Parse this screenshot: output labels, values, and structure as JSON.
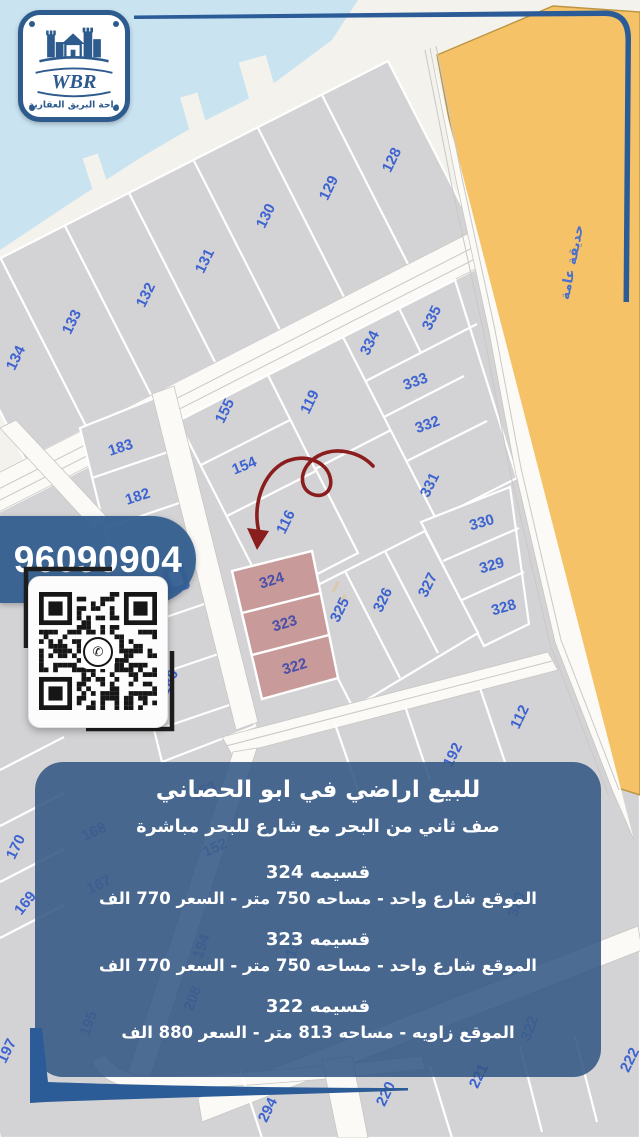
{
  "logo": {
    "brand": "WBR",
    "tagline": "واحة البريق العقارية"
  },
  "phone": "96090904",
  "map": {
    "park_label": "حديقة عامة",
    "highlighted_plots": [
      "324",
      "323",
      "322"
    ],
    "plots": [
      {
        "n": "128",
        "x": 396,
        "y": 162,
        "r": -64
      },
      {
        "n": "129",
        "x": 333,
        "y": 190,
        "r": -64
      },
      {
        "n": "130",
        "x": 270,
        "y": 218,
        "r": -64
      },
      {
        "n": "131",
        "x": 209,
        "y": 263,
        "r": -64
      },
      {
        "n": "132",
        "x": 150,
        "y": 297,
        "r": -64
      },
      {
        "n": "133",
        "x": 76,
        "y": 324,
        "r": -64
      },
      {
        "n": "134",
        "x": 20,
        "y": 360,
        "r": -64
      },
      {
        "n": "335",
        "x": 436,
        "y": 320,
        "r": -64
      },
      {
        "n": "334",
        "x": 374,
        "y": 345,
        "r": -64
      },
      {
        "n": "155",
        "x": 229,
        "y": 413,
        "r": -64
      },
      {
        "n": "119",
        "x": 314,
        "y": 404,
        "r": -64
      },
      {
        "n": "154",
        "x": 246,
        "y": 470,
        "r": -22
      },
      {
        "n": "116",
        "x": 290,
        "y": 524,
        "r": -64
      },
      {
        "n": "333",
        "x": 417,
        "y": 386,
        "r": -20
      },
      {
        "n": "332",
        "x": 429,
        "y": 429,
        "r": -20
      },
      {
        "n": "331",
        "x": 434,
        "y": 487,
        "r": -64
      },
      {
        "n": "330",
        "x": 483,
        "y": 527,
        "r": -16
      },
      {
        "n": "329",
        "x": 493,
        "y": 570,
        "r": -16
      },
      {
        "n": "328",
        "x": 505,
        "y": 612,
        "r": -16
      },
      {
        "n": "327",
        "x": 432,
        "y": 587,
        "r": -64
      },
      {
        "n": "326",
        "x": 387,
        "y": 602,
        "r": -64
      },
      {
        "n": "325",
        "x": 344,
        "y": 612,
        "r": -64
      },
      {
        "n": "324",
        "x": 273,
        "y": 585,
        "r": -17,
        "s": "h"
      },
      {
        "n": "323",
        "x": 286,
        "y": 628,
        "r": -17,
        "s": "h"
      },
      {
        "n": "322",
        "x": 296,
        "y": 671,
        "r": -17,
        "s": "h"
      },
      {
        "n": "183",
        "x": 122,
        "y": 452,
        "r": -18
      },
      {
        "n": "182",
        "x": 139,
        "y": 501,
        "r": -18
      },
      {
        "n": "186",
        "x": 173,
        "y": 684,
        "r": -64
      },
      {
        "n": "112",
        "x": 524,
        "y": 719,
        "r": -64
      },
      {
        "n": "192",
        "x": 457,
        "y": 757,
        "r": -64
      },
      {
        "n": "170",
        "x": 20,
        "y": 849,
        "r": -64
      },
      {
        "n": "169",
        "x": 29,
        "y": 906,
        "r": -52
      },
      {
        "n": "197",
        "x": 11,
        "y": 1053,
        "r": -64
      },
      {
        "n": "294",
        "x": 272,
        "y": 1112,
        "r": -64
      },
      {
        "n": "220",
        "x": 390,
        "y": 1096,
        "r": -64
      },
      {
        "n": "221",
        "x": 483,
        "y": 1078,
        "r": -64
      },
      {
        "n": "222",
        "x": 634,
        "y": 1062,
        "r": -64
      },
      {
        "n": "168",
        "x": 96,
        "y": 836,
        "r": -25,
        "s": "f"
      },
      {
        "n": "167",
        "x": 101,
        "y": 889,
        "r": -25,
        "s": "f"
      },
      {
        "n": "153",
        "x": 206,
        "y": 795,
        "r": -25,
        "s": "f"
      },
      {
        "n": "152",
        "x": 217,
        "y": 852,
        "r": -25,
        "s": "f"
      },
      {
        "n": "194",
        "x": 206,
        "y": 948,
        "r": -70,
        "s": "f"
      },
      {
        "n": "208",
        "x": 197,
        "y": 1000,
        "r": -70,
        "s": "f"
      },
      {
        "n": "195",
        "x": 93,
        "y": 1025,
        "r": -70,
        "s": "f"
      },
      {
        "n": "319",
        "x": 296,
        "y": 955,
        "r": -70,
        "s": "f"
      },
      {
        "n": "320",
        "x": 521,
        "y": 906,
        "r": -70,
        "s": "f"
      },
      {
        "n": "322",
        "x": 534,
        "y": 1030,
        "r": -70,
        "s": "f"
      }
    ]
  },
  "panel": {
    "title": "للبيع اراضي في ابو الحصاني",
    "subtitle": "صف ثاني من البحر مع شارع للبحر مباشرة",
    "listings": [
      {
        "name": "قسيمه 324",
        "details": "الموقع شارع واحد - مساحه 750 متر - السعر 770 الف"
      },
      {
        "name": "قسيمه 323",
        "details": "الموقع شارع واحد - مساحه 750 متر - السعر 770 الف"
      },
      {
        "name": "قسيمه 322",
        "details": "الموقع زاويه - مساحه 813 متر - السعر 880 الف"
      }
    ]
  },
  "colors": {
    "accent_blue": "#2d5b8e",
    "panel_blue": "#325684",
    "park_orange": "#f5c268",
    "highlight_pink": "#c89a9a",
    "plot_number_blue": "#3d63d0",
    "arrow_red": "#8a1d1d"
  }
}
